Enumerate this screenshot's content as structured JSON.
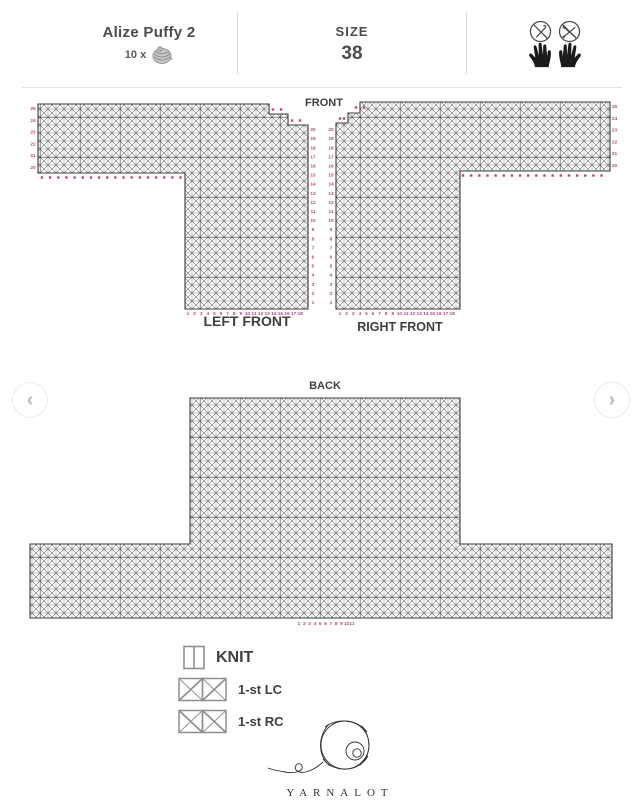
{
  "header": {
    "yarn_name": "Alize Puffy 2",
    "yarn_count_label": "10 x",
    "size_label": "SIZE",
    "size_value": "38",
    "icon_names": [
      "no-crochet-hook",
      "no-knitting-needles",
      "left-hand",
      "right-hand"
    ]
  },
  "front_chart": {
    "title": "FRONT",
    "left_piece_label": "LEFT FRONT",
    "right_piece_label": "RIGHT FRONT"
  },
  "back_chart": {
    "title": "BACK"
  },
  "legend": {
    "items": [
      {
        "symbol": "knit-box",
        "label": "KNIT"
      },
      {
        "symbol": "left-cross-boxes",
        "label": "1-st LC"
      },
      {
        "symbol": "right-cross-boxes",
        "label": "1-st RC"
      }
    ]
  },
  "nav": {
    "prev": "‹",
    "next": "›"
  },
  "footer": {
    "brand": "YARNALOT"
  },
  "colors": {
    "accent_pink": "#b2487e",
    "label_gray": "#3f3f3f",
    "grid_dark": "#3a3a3a",
    "grid_light": "#8f8f8f"
  },
  "markers": {
    "left_front": {
      "underarm": {
        "from": 1,
        "to": 18
      },
      "outer_edge": [
        25,
        24,
        23,
        22,
        21,
        20
      ],
      "center_edge": {
        "from": 1,
        "to": 20
      },
      "bottom": {
        "from": 1,
        "to": 18
      }
    },
    "right_front": {
      "underarm": {
        "from": 1,
        "to": 18
      },
      "outer_edge": [
        25,
        24,
        23,
        22,
        21,
        20
      ],
      "center_edge": {
        "from": 1,
        "to": 20
      },
      "bottom": {
        "from": 1,
        "to": 18
      }
    },
    "back": {
      "bottom": {
        "from": 1,
        "to": 11
      }
    }
  }
}
